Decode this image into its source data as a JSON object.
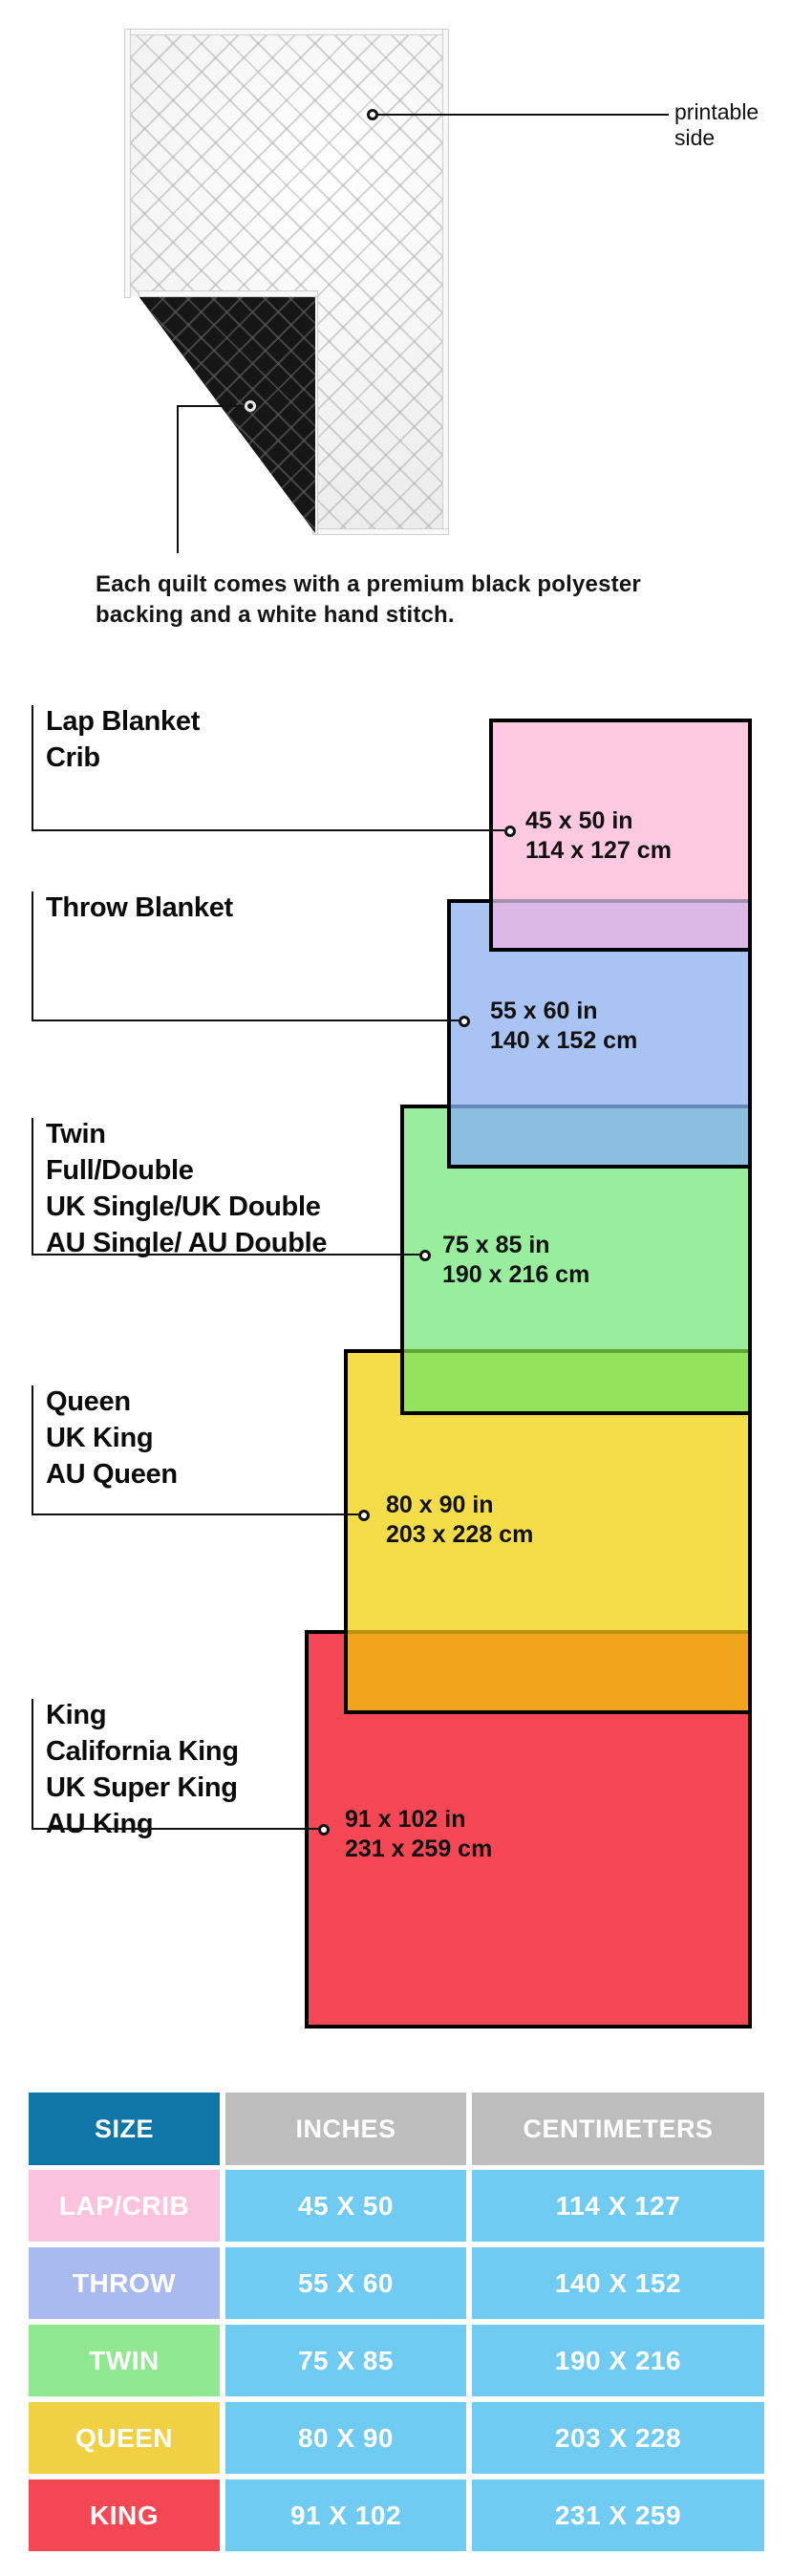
{
  "fabric": {
    "printable_label": "printable side",
    "caption_line1": "Each quilt comes with a premium black polyester",
    "caption_line2": "backing and a white hand stitch."
  },
  "diagram": {
    "blankets": [
      {
        "name": "lap-crib",
        "labels": [
          "Lap Blanket",
          "Crib"
        ],
        "inches": "45 x 50 in",
        "centimeters": "114 x 127 cm",
        "fill": "#FCC9E1"
      },
      {
        "name": "throw",
        "labels": [
          "Throw Blanket"
        ],
        "inches": "55 x 60 in",
        "centimeters": "140 x 152 cm",
        "fill": "#A9C3F2"
      },
      {
        "name": "twin",
        "labels": [
          "Twin",
          "Full/Double",
          "UK Single/UK Double",
          "AU Single/ AU Double"
        ],
        "inches": "75 x 85 in",
        "centimeters": "190 x 216 cm",
        "fill": "#98EE9C"
      },
      {
        "name": "queen",
        "labels": [
          "Queen",
          "UK King",
          "AU Queen"
        ],
        "inches": "80 x 90 in",
        "centimeters": "203 x 228 cm",
        "fill": "#F5DC49"
      },
      {
        "name": "king",
        "labels": [
          "King",
          "California King",
          "UK Super King",
          "AU King"
        ],
        "inches": "91 x 102 in",
        "centimeters": "231 x 259 cm",
        "fill": "#F64754"
      }
    ],
    "overlap_colors": {
      "lap_throw": "#DCB8E6",
      "throw_twin": "#8CBEDF",
      "twin_queen": "#93E35C",
      "queen_king": "#F2A41C"
    }
  },
  "table": {
    "headers": [
      "SIZE",
      "INCHES",
      "CENTIMETERS"
    ],
    "header_size_color": "#0F76A8",
    "header_other_color": "#BDBDBD",
    "data_cell_color": "#6FCBF2",
    "rows": [
      {
        "size": "LAP/CRIB",
        "inches": "45 X 50",
        "centimeters": "114 X 127",
        "color": "#FBC3DD"
      },
      {
        "size": "THROW",
        "inches": "55 X 60",
        "centimeters": "140 X 152",
        "color": "#A9BAF0"
      },
      {
        "size": "TWIN",
        "inches": "75 X 85",
        "centimeters": "190 X 216",
        "color": "#90E890"
      },
      {
        "size": "QUEEN",
        "inches": "80 X 90",
        "centimeters": "203 X 228",
        "color": "#F0D143"
      },
      {
        "size": "KING",
        "inches": "91 X 102",
        "centimeters": "231 X 259",
        "color": "#F64754"
      }
    ]
  }
}
